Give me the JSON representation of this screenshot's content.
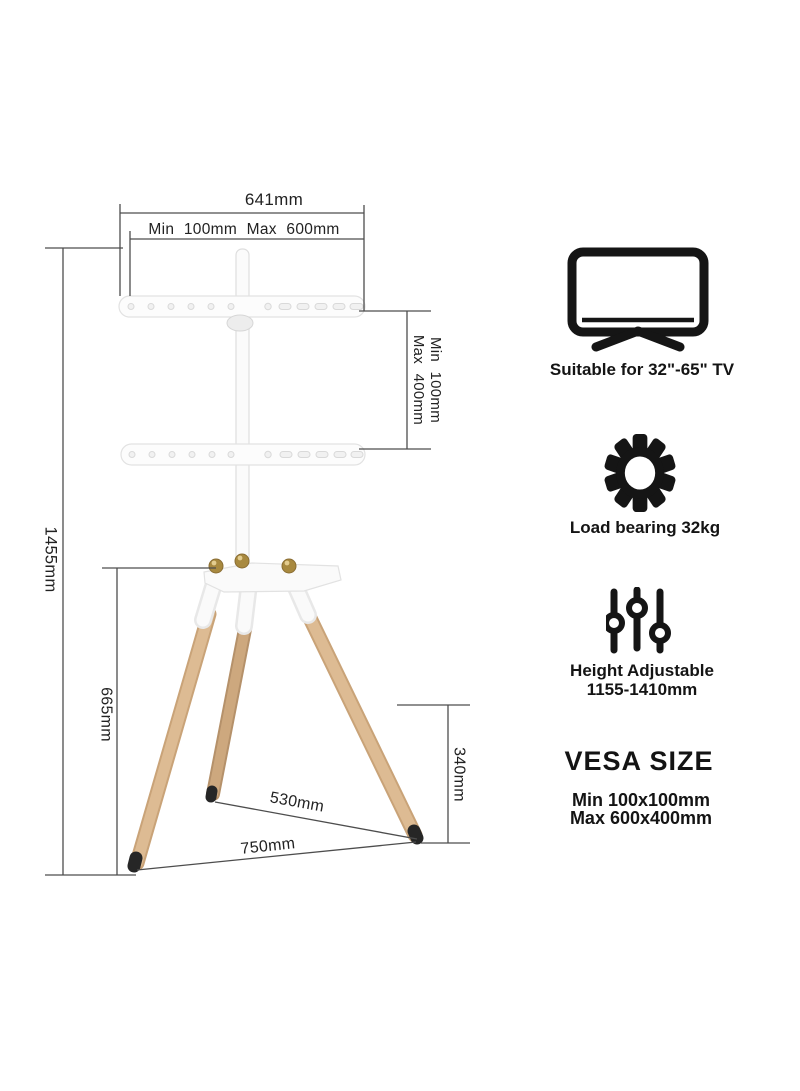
{
  "colors": {
    "dim_line": "#4d4d4d",
    "wood": "#d2ab80",
    "brass": "#a8893f",
    "icon_black": "#151515",
    "part_white": "#fbfbfb"
  },
  "diagram": {
    "labels": {
      "total_width": "641mm",
      "mount_width_range": "Min 100mm Max 600mm",
      "mount_height_min": "Min 100mm",
      "mount_height_max": "Max 400mm",
      "total_height": "1455mm",
      "hub_height": "665mm",
      "rear_leg_height": "340mm",
      "inner_span": "530mm",
      "outer_span": "750mm"
    }
  },
  "features": {
    "tv": {
      "icon": "tv-icon",
      "label": "Suitable for 32\"-65\" TV"
    },
    "load": {
      "icon": "gear-icon",
      "label": "Load bearing 32kg"
    },
    "height": {
      "icon": "sliders-icon",
      "label_line1": "Height Adjustable",
      "label_line2": "1155-1410mm"
    },
    "vesa": {
      "heading": "VESA SIZE",
      "min": "Min 100x100mm",
      "max": "Max 600x400mm"
    }
  }
}
